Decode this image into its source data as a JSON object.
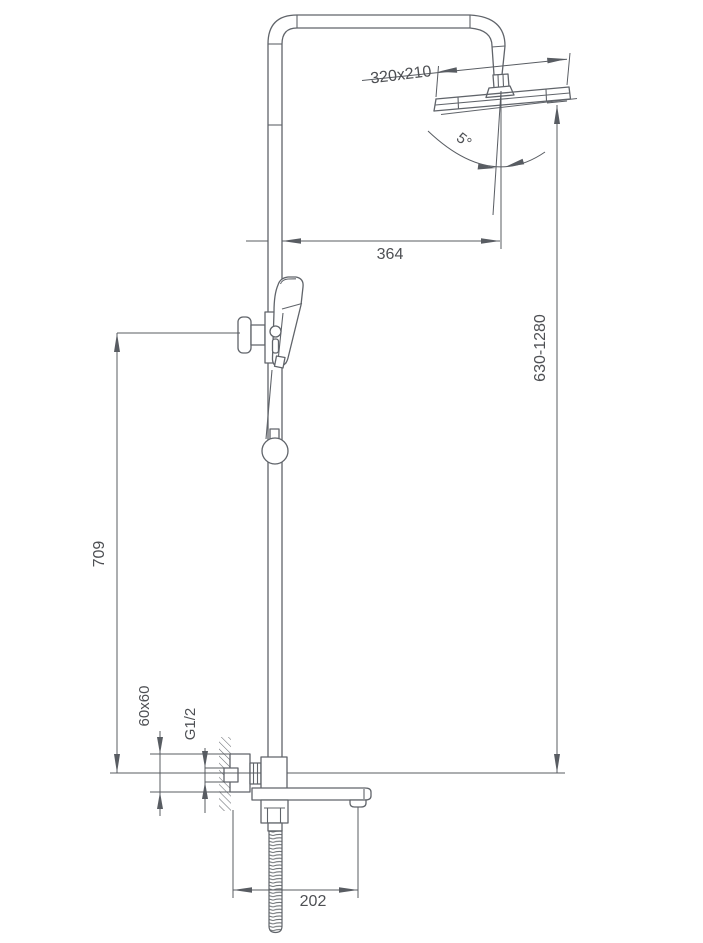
{
  "diagram": {
    "title": "Shower column installation drawing",
    "background_color": "#ffffff",
    "line_color": "#60646a",
    "dimension_color": "#585c62",
    "text_color": "#4e5054",
    "labels": {
      "head_size": "320x210",
      "tilt_angle": "5°",
      "arm_reach": "364",
      "riser_height": "630-1280",
      "slider_height": "709",
      "escutcheon_size": "60x60",
      "thread_size": "G1/2",
      "spout_length": "202"
    }
  }
}
